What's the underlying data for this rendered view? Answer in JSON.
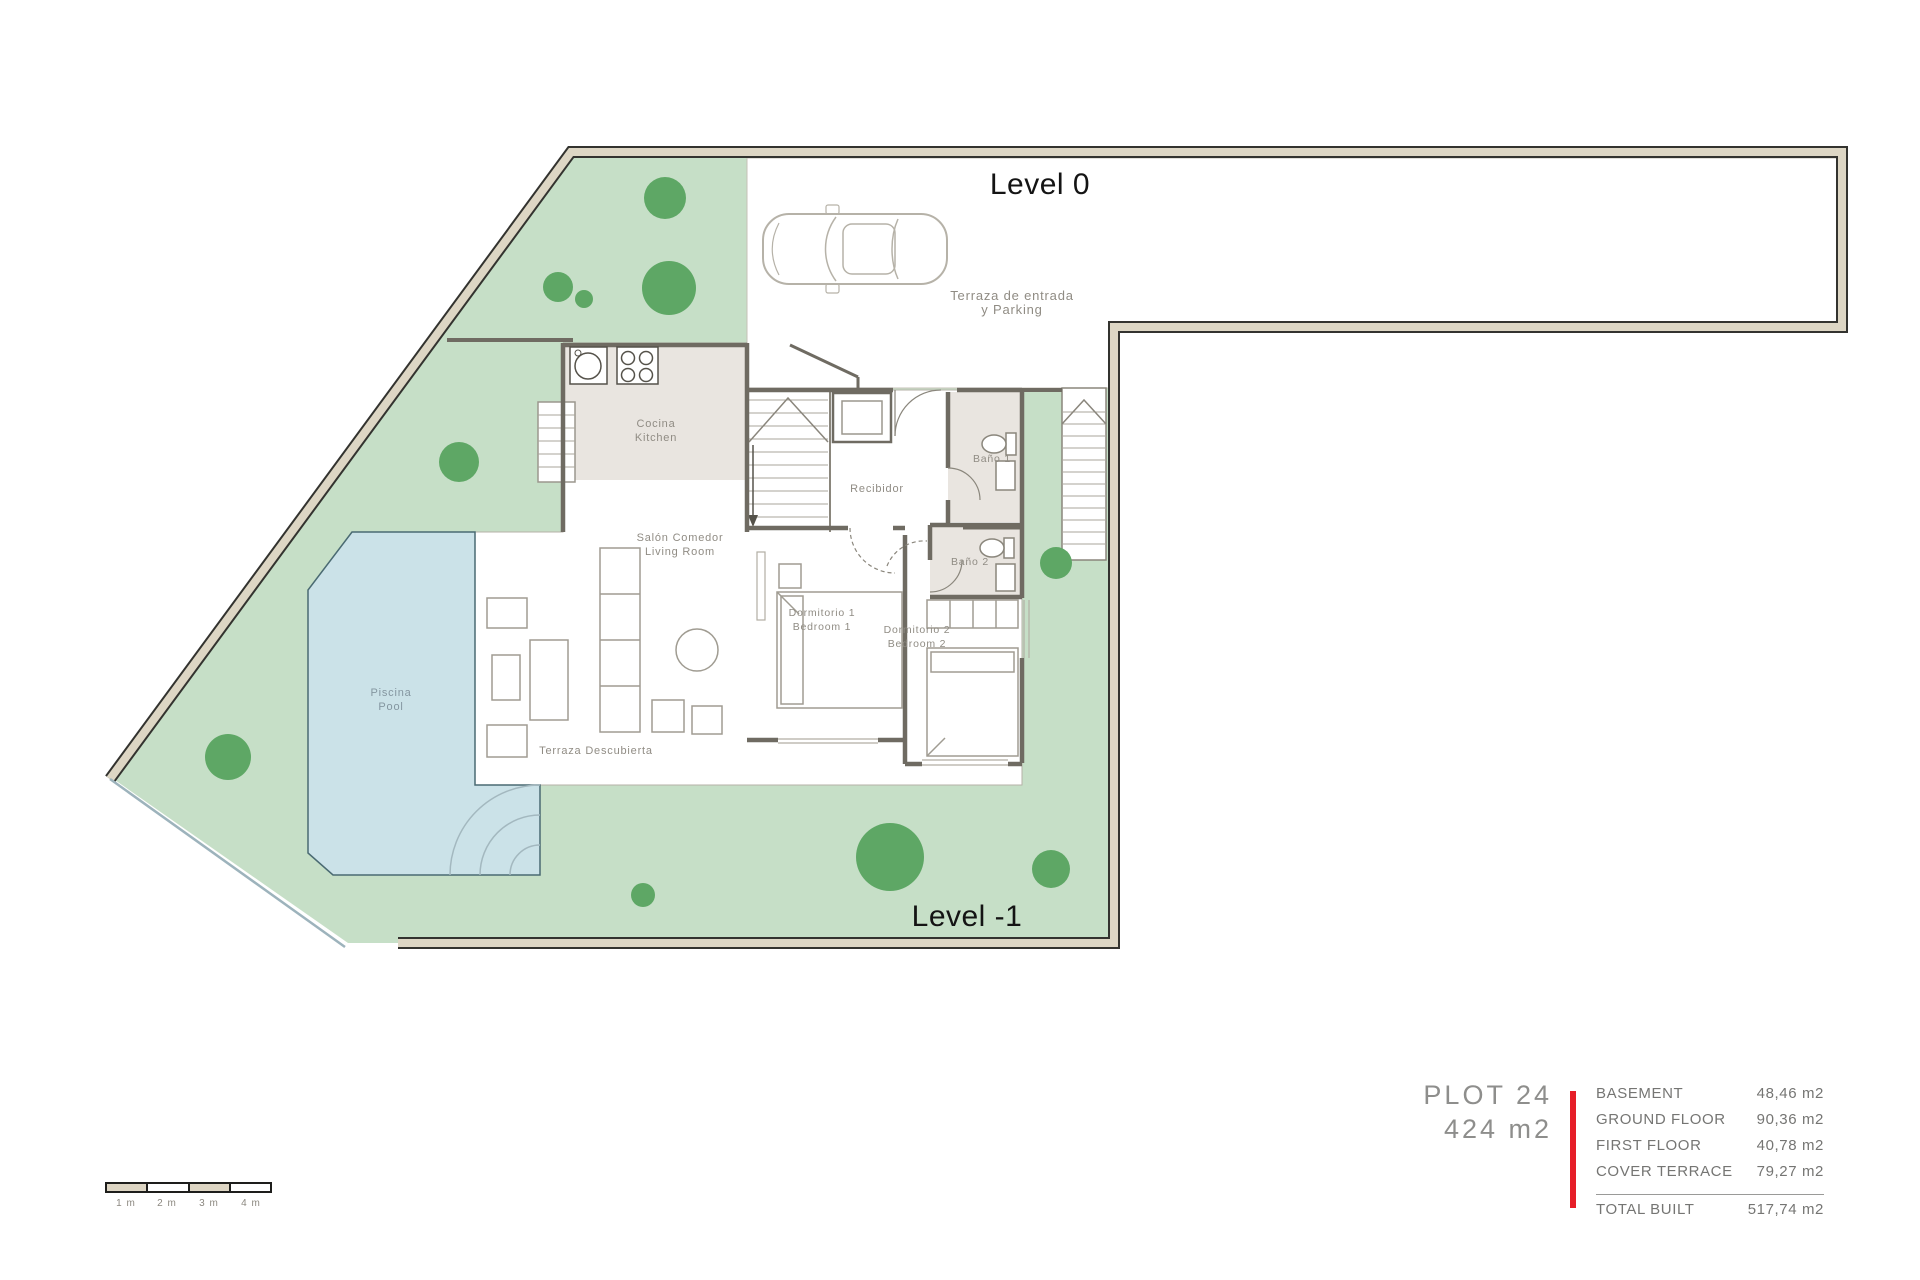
{
  "plan": {
    "levels": {
      "level0": "Level 0",
      "level_minus_1": "Level -1"
    },
    "rooms": {
      "kitchen": {
        "es": "Cocina",
        "en": "Kitchen"
      },
      "living": {
        "es": "Salón Comedor",
        "en": "Living Room"
      },
      "hall": {
        "label": "Recibidor"
      },
      "bath1": {
        "label": "Baño 1"
      },
      "bath2": {
        "label": "Baño 2"
      },
      "bedroom1": {
        "es": "Dormitorio 1",
        "en": "Bedroom 1"
      },
      "bedroom2": {
        "es": "Dormitorio 2",
        "en": "Bedroom 2"
      },
      "pool": {
        "es": "Piscina",
        "en": "Pool"
      },
      "open_terrace": {
        "label": "Terraza Descubierta"
      },
      "entry_terrace": {
        "line1": "Terraza de entrada",
        "line2": "y Parking"
      }
    }
  },
  "legend": {
    "plot_title": "PLOT 24",
    "plot_area": "424 m2",
    "rows": [
      {
        "label": "BASEMENT",
        "value": "48,46 m2"
      },
      {
        "label": "GROUND FLOOR",
        "value": "90,36 m2"
      },
      {
        "label": "FIRST FLOOR",
        "value": "40,78 m2"
      },
      {
        "label": "COVER TERRACE",
        "value": "79,27 m2"
      }
    ],
    "total": {
      "label": "TOTAL BUILT",
      "value": "517,74 m2"
    }
  },
  "scale_bar": {
    "labels": [
      "1 m",
      "2 m",
      "3 m",
      "4 m"
    ]
  },
  "colors": {
    "accent_red": "#e61e28",
    "garden_green": "#c6dfc7",
    "tree_green": "#5ea765",
    "pool_blue": "#cbe2e8",
    "border_beige": "#ddd6c4",
    "wall_gray": "#6f6b62",
    "floor_beige": "#e9e5e0"
  }
}
